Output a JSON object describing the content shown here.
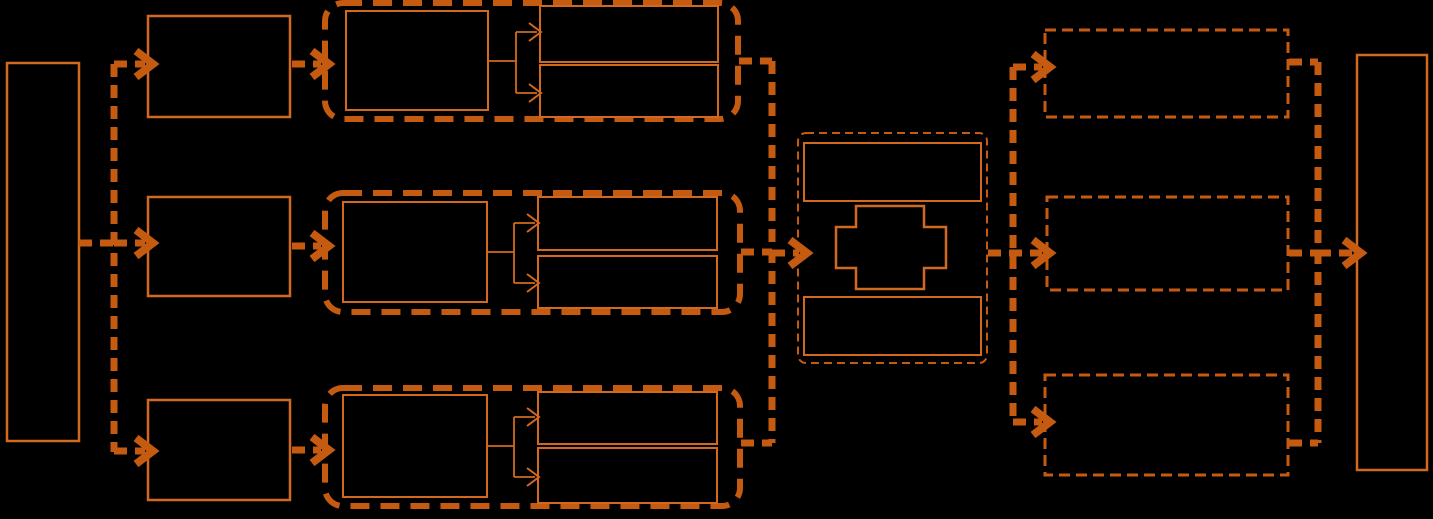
{
  "canvas": {
    "width": 1433,
    "height": 519,
    "background": "#000000"
  },
  "colors": {
    "heavy": "#C55A11",
    "thin": "#D2691E"
  },
  "diagram": {
    "rects": [
      {
        "name": "left-source-box",
        "x": 7,
        "y": 63,
        "w": 72,
        "h": 378,
        "stroke": "thin",
        "sw": 2.5
      },
      {
        "name": "row1-input-box",
        "x": 148,
        "y": 16,
        "w": 142,
        "h": 101,
        "stroke": "thin",
        "sw": 2.5
      },
      {
        "name": "row2-input-box",
        "x": 148,
        "y": 197,
        "w": 142,
        "h": 99,
        "stroke": "thin",
        "sw": 2.5
      },
      {
        "name": "row3-input-box",
        "x": 148,
        "y": 400,
        "w": 142,
        "h": 100,
        "stroke": "thin",
        "sw": 2.5
      },
      {
        "name": "row1-stage-container",
        "x": 325,
        "y": 3,
        "w": 413,
        "h": 116,
        "stroke": "heavy",
        "sw": 6,
        "dash": "19 11",
        "rx": 18
      },
      {
        "name": "row2-stage-container",
        "x": 325,
        "y": 193,
        "w": 415,
        "h": 119,
        "stroke": "heavy",
        "sw": 6,
        "dash": "19 11",
        "rx": 18
      },
      {
        "name": "row3-stage-container",
        "x": 325,
        "y": 388,
        "w": 415,
        "h": 118,
        "stroke": "heavy",
        "sw": 6,
        "dash": "19 11",
        "rx": 18
      },
      {
        "name": "row1-stage-left-box",
        "x": 346,
        "y": 11,
        "w": 142,
        "h": 99,
        "stroke": "thin",
        "sw": 2
      },
      {
        "name": "row1-stage-top-box",
        "x": 540,
        "y": 6,
        "w": 178,
        "h": 56,
        "stroke": "thin",
        "sw": 2
      },
      {
        "name": "row1-stage-bottom-box",
        "x": 540,
        "y": 65,
        "w": 178,
        "h": 52,
        "stroke": "thin",
        "sw": 2
      },
      {
        "name": "row2-stage-left-box",
        "x": 343,
        "y": 202,
        "w": 144,
        "h": 100,
        "stroke": "thin",
        "sw": 2
      },
      {
        "name": "row2-stage-top-box",
        "x": 538,
        "y": 197,
        "w": 179,
        "h": 53,
        "stroke": "thin",
        "sw": 2
      },
      {
        "name": "row2-stage-bottom-box",
        "x": 538,
        "y": 256,
        "w": 179,
        "h": 52,
        "stroke": "thin",
        "sw": 2
      },
      {
        "name": "row3-stage-left-box",
        "x": 343,
        "y": 395,
        "w": 144,
        "h": 102,
        "stroke": "thin",
        "sw": 2
      },
      {
        "name": "row3-stage-top-box",
        "x": 538,
        "y": 392,
        "w": 179,
        "h": 52,
        "stroke": "thin",
        "sw": 2
      },
      {
        "name": "row3-stage-bottom-box",
        "x": 538,
        "y": 448,
        "w": 179,
        "h": 55,
        "stroke": "thin",
        "sw": 2
      },
      {
        "name": "center-merge-container",
        "x": 798,
        "y": 133,
        "w": 189,
        "h": 230,
        "stroke": "heavy",
        "sw": 2,
        "dash": "8 5",
        "rx": 8
      },
      {
        "name": "center-top-box",
        "x": 804,
        "y": 143,
        "w": 177,
        "h": 58,
        "stroke": "thin",
        "sw": 2
      },
      {
        "name": "center-bottom-box",
        "x": 804,
        "y": 297,
        "w": 177,
        "h": 58,
        "stroke": "thin",
        "sw": 2
      },
      {
        "name": "right-row1-result-box",
        "x": 1045,
        "y": 30,
        "w": 243,
        "h": 87,
        "stroke": "heavy",
        "sw": 3,
        "dash": "11 6"
      },
      {
        "name": "right-row2-result-box",
        "x": 1047,
        "y": 197,
        "w": 241,
        "h": 93,
        "stroke": "heavy",
        "sw": 3,
        "dash": "11 6"
      },
      {
        "name": "right-row3-result-box",
        "x": 1045,
        "y": 375,
        "w": 243,
        "h": 100,
        "stroke": "heavy",
        "sw": 3,
        "dash": "11 6"
      },
      {
        "name": "right-sink-box",
        "x": 1357,
        "y": 55,
        "w": 70,
        "h": 415,
        "stroke": "thin",
        "sw": 2.5
      }
    ],
    "polygons": [
      {
        "name": "center-plus-shape",
        "points": "856,206 924,206 924,227 946,227 946,268 924,268 924,289 856,289 856,268 836,268 836,227 856,227",
        "stroke": "thin",
        "sw": 2.5
      }
    ],
    "connectors": [
      {
        "name": "source-out-stem",
        "pts": [
          [
            79,
            243
          ],
          [
            114,
            243
          ]
        ],
        "stroke": "heavy",
        "sw": 7,
        "dash": "13 8"
      },
      {
        "name": "left-split-line",
        "pts": [
          [
            114,
            64
          ],
          [
            114,
            452
          ]
        ],
        "stroke": "heavy",
        "sw": 7,
        "dash": "13 8"
      },
      {
        "name": "left-arrow-row1",
        "pts": [
          [
            114,
            64
          ],
          [
            145,
            64
          ]
        ],
        "stroke": "heavy",
        "sw": 7,
        "dash": "13 8",
        "head": "chevron"
      },
      {
        "name": "left-arrow-row2",
        "pts": [
          [
            114,
            243
          ],
          [
            145,
            243
          ]
        ],
        "stroke": "heavy",
        "sw": 7,
        "dash": "13 8",
        "head": "chevron"
      },
      {
        "name": "left-arrow-row3",
        "pts": [
          [
            114,
            451
          ],
          [
            145,
            451
          ]
        ],
        "stroke": "heavy",
        "sw": 7,
        "dash": "13 8",
        "head": "chevron"
      },
      {
        "name": "row1-input-arrow",
        "pts": [
          [
            292,
            64
          ],
          [
            321,
            64
          ]
        ],
        "stroke": "heavy",
        "sw": 7,
        "dash": "13 8",
        "head": "chevron"
      },
      {
        "name": "row2-input-arrow",
        "pts": [
          [
            292,
            246
          ],
          [
            321,
            246
          ]
        ],
        "stroke": "heavy",
        "sw": 7,
        "dash": "13 8",
        "head": "chevron"
      },
      {
        "name": "row3-input-arrow",
        "pts": [
          [
            292,
            450
          ],
          [
            321,
            450
          ]
        ],
        "stroke": "heavy",
        "sw": 7,
        "dash": "13 8",
        "head": "chevron"
      },
      {
        "name": "row1-branch-stem",
        "pts": [
          [
            488,
            61
          ],
          [
            516,
            61
          ]
        ],
        "stroke": "thin",
        "sw": 1.8
      },
      {
        "name": "row1-branch-line",
        "pts": [
          [
            516,
            32
          ],
          [
            516,
            93
          ]
        ],
        "stroke": "thin",
        "sw": 1.8
      },
      {
        "name": "row1-branch-arrow-top",
        "pts": [
          [
            516,
            32
          ],
          [
            537,
            32
          ]
        ],
        "stroke": "thin",
        "sw": 1.8,
        "head": "vee"
      },
      {
        "name": "row1-branch-arrow-bot",
        "pts": [
          [
            516,
            93
          ],
          [
            537,
            93
          ]
        ],
        "stroke": "thin",
        "sw": 1.8,
        "head": "vee"
      },
      {
        "name": "row2-branch-stem",
        "pts": [
          [
            487,
            252
          ],
          [
            514,
            252
          ]
        ],
        "stroke": "thin",
        "sw": 1.8
      },
      {
        "name": "row2-branch-line",
        "pts": [
          [
            514,
            223
          ],
          [
            514,
            283
          ]
        ],
        "stroke": "thin",
        "sw": 1.8
      },
      {
        "name": "row2-branch-arrow-top",
        "pts": [
          [
            514,
            223
          ],
          [
            535,
            223
          ]
        ],
        "stroke": "thin",
        "sw": 1.8,
        "head": "vee"
      },
      {
        "name": "row2-branch-arrow-bot",
        "pts": [
          [
            514,
            283
          ],
          [
            535,
            283
          ]
        ],
        "stroke": "thin",
        "sw": 1.8,
        "head": "vee"
      },
      {
        "name": "row3-branch-stem",
        "pts": [
          [
            487,
            446
          ],
          [
            514,
            446
          ]
        ],
        "stroke": "thin",
        "sw": 1.8
      },
      {
        "name": "row3-branch-line",
        "pts": [
          [
            514,
            417
          ],
          [
            514,
            477
          ]
        ],
        "stroke": "thin",
        "sw": 1.8
      },
      {
        "name": "row3-branch-arrow-top",
        "pts": [
          [
            514,
            417
          ],
          [
            535,
            417
          ]
        ],
        "stroke": "thin",
        "sw": 1.8,
        "head": "vee"
      },
      {
        "name": "row3-branch-arrow-bot",
        "pts": [
          [
            514,
            477
          ],
          [
            535,
            477
          ]
        ],
        "stroke": "thin",
        "sw": 1.8,
        "head": "vee"
      },
      {
        "name": "collect-row1-stub",
        "pts": [
          [
            739,
            61
          ],
          [
            772,
            61
          ]
        ],
        "stroke": "heavy",
        "sw": 7,
        "dash": "13 8"
      },
      {
        "name": "collect-row2-stub",
        "pts": [
          [
            741,
            252
          ],
          [
            772,
            252
          ]
        ],
        "stroke": "heavy",
        "sw": 7,
        "dash": "13 8"
      },
      {
        "name": "collect-row3-stub",
        "pts": [
          [
            741,
            443
          ],
          [
            772,
            443
          ]
        ],
        "stroke": "heavy",
        "sw": 7,
        "dash": "13 8"
      },
      {
        "name": "collect-line",
        "pts": [
          [
            772,
            61
          ],
          [
            772,
            443
          ]
        ],
        "stroke": "heavy",
        "sw": 7,
        "dash": "13 8"
      },
      {
        "name": "center-in-arrow",
        "pts": [
          [
            772,
            253
          ],
          [
            799,
            253
          ]
        ],
        "stroke": "heavy",
        "sw": 7,
        "dash": "13 8",
        "head": "chevron"
      },
      {
        "name": "center-out-arrow",
        "pts": [
          [
            988,
            253
          ],
          [
            1042,
            253
          ]
        ],
        "stroke": "heavy",
        "sw": 7,
        "dash": "13 8",
        "head": "chevron"
      },
      {
        "name": "dist-line",
        "pts": [
          [
            1013,
            67
          ],
          [
            1013,
            422
          ]
        ],
        "stroke": "heavy",
        "sw": 7,
        "dash": "13 8"
      },
      {
        "name": "dist-arrow-row1",
        "pts": [
          [
            1013,
            67
          ],
          [
            1042,
            67
          ]
        ],
        "stroke": "heavy",
        "sw": 7,
        "dash": "13 8",
        "head": "chevron"
      },
      {
        "name": "dist-arrow-row3",
        "pts": [
          [
            1013,
            422
          ],
          [
            1042,
            422
          ]
        ],
        "stroke": "heavy",
        "sw": 7,
        "dash": "13 8",
        "head": "chevron"
      },
      {
        "name": "result-row1-stub",
        "pts": [
          [
            1289,
            62
          ],
          [
            1318,
            62
          ]
        ],
        "stroke": "heavy",
        "sw": 7,
        "dash": "13 8"
      },
      {
        "name": "result-row2-stub",
        "pts": [
          [
            1289,
            253
          ],
          [
            1318,
            253
          ]
        ],
        "stroke": "heavy",
        "sw": 7,
        "dash": "13 8"
      },
      {
        "name": "result-row3-stub",
        "pts": [
          [
            1289,
            443
          ],
          [
            1318,
            443
          ]
        ],
        "stroke": "heavy",
        "sw": 7,
        "dash": "13 8"
      },
      {
        "name": "result-collect-line",
        "pts": [
          [
            1318,
            62
          ],
          [
            1318,
            443
          ]
        ],
        "stroke": "heavy",
        "sw": 7,
        "dash": "13 8"
      },
      {
        "name": "sink-arrow",
        "pts": [
          [
            1318,
            253
          ],
          [
            1353,
            253
          ]
        ],
        "stroke": "heavy",
        "sw": 7,
        "dash": "13 8",
        "head": "chevron"
      }
    ]
  }
}
